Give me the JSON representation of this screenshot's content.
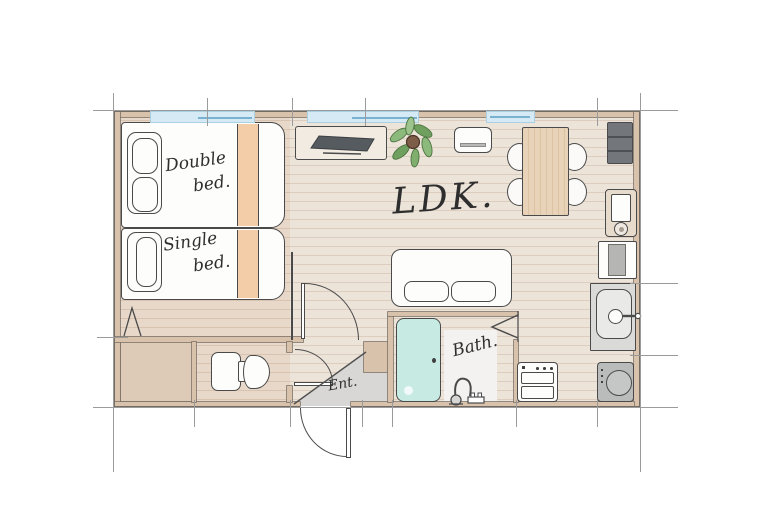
{
  "labels": {
    "ldk": "LDK.",
    "bath": "Bath.",
    "entrance": "Ent.",
    "double_bed_line1": "Double",
    "double_bed_line2": "bed.",
    "single_bed_line1": "Single",
    "single_bed_line2": "bed."
  },
  "items": [
    "double-bed",
    "single-bed",
    "closet",
    "toilet",
    "tv-board",
    "tv",
    "potted-plant",
    "air-conditioner",
    "dining-table",
    "dining-chair",
    "refrigerator",
    "vanity-unit",
    "microwave-shelf",
    "kitchen-sink",
    "washing-machine",
    "stove-oven",
    "sofa",
    "bathtub",
    "shower-faucet",
    "entrance-door",
    "interior-door",
    "washroom-door",
    "bath-folding-door",
    "window"
  ],
  "colors": {
    "floor": "#ece3d9",
    "plank": "#dccdbe",
    "bedfloor": "#e8d8ca",
    "bedplank": "#d8c3b1",
    "wall": "#d8c2ac",
    "closet": "#ddcbb7",
    "entrance_gray": "#d8d7d5",
    "bath_white": "#f3f2f0",
    "window_blue": "#d5eaf4",
    "window_line": "#79b2d0",
    "peach": "#f2cda7",
    "mint": "#c7ebe3",
    "wood_table": "#e9d3b8",
    "dark_appliance": "#73777b",
    "tv_dark": "#565b60",
    "counter_gray": "#dadad8",
    "washer_gray": "#b9bcbb",
    "leaf_green": "#8cb97c",
    "leaf_green2": "#6fa05f",
    "pot_brown": "#7d5c48",
    "line": "#4a4a4a",
    "dim": "#9b9b9b",
    "text": "#2e2e2e"
  }
}
